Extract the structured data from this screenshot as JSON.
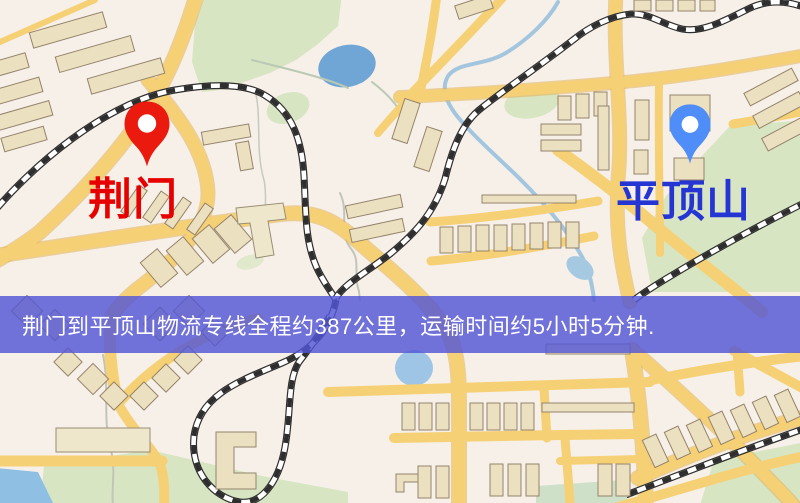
{
  "map": {
    "origin": {
      "name": "荆门",
      "marker": "red-pin",
      "marker_color": "#ea1b0e",
      "label_color": "#e60000"
    },
    "destination": {
      "name": "平顶山",
      "marker": "blue-pin",
      "marker_color": "#4f8ef8",
      "label_color": "#2435d4"
    },
    "route_banner": {
      "text": "荆门到平顶山物流专线全程约387公里，运输时间约5小时5分钟.",
      "background_color": "#5356d6",
      "text_color": "#ffffff"
    },
    "palette": {
      "map_background": "#f7f0e8",
      "road_fill": "#f6d075",
      "road_casing": "#e2b254",
      "building_fill": "#ebe1c1",
      "building_outline": "#95836b",
      "park_green": "#d7e5c2",
      "water_blue": "#6fa6d6",
      "railway_black": "#2e2e2e"
    }
  }
}
